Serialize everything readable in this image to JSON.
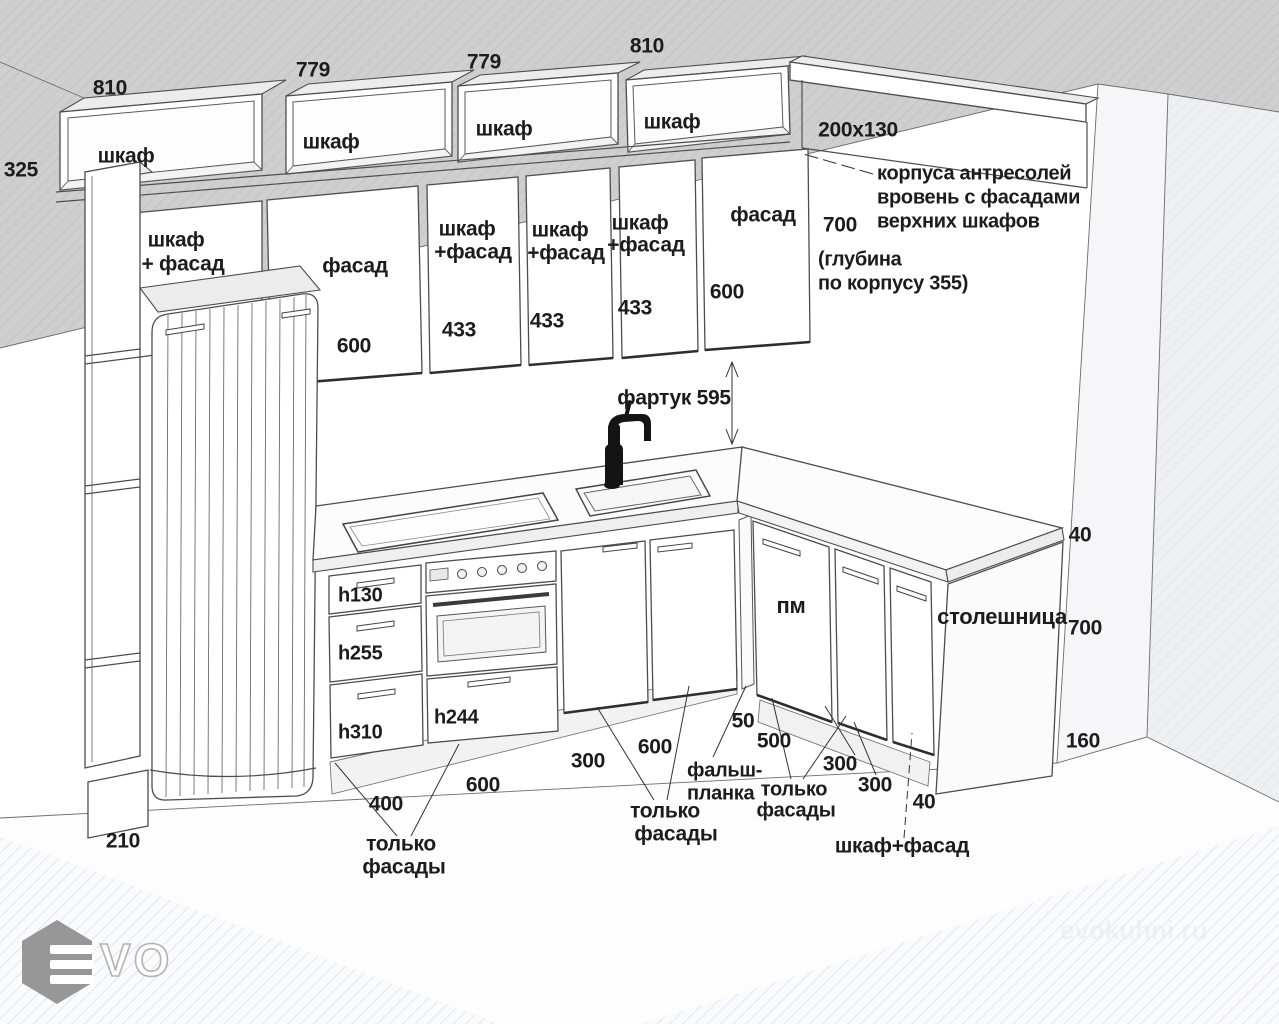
{
  "scene": {
    "top_dims": [
      "810",
      "779",
      "779",
      "810"
    ],
    "left_dim": "325",
    "antresol": [
      "шкаф",
      "шкаф",
      "шкаф",
      "шкаф"
    ],
    "niche_dim": "200x130",
    "note": {
      "l1": "корпуса антресолей",
      "l2": "вровень с фасадами",
      "l3": "верхних шкафов"
    },
    "upper_height": "700",
    "depth_note": {
      "l1": "(глубина",
      "l2": "по корпусу 355)"
    },
    "uppers": {
      "c1l1": "шкаф",
      "c1l2": "+ фасад",
      "c2": "фасад",
      "c2s": "600",
      "c3l1": "шкаф",
      "c3l2": "+фасад",
      "c3s": "433",
      "c4l1": "шкаф",
      "c4l2": "+фасад",
      "c4s": "433",
      "c5l1": "шкаф",
      "c5l2": "+фасад",
      "c5s": "433",
      "c6": "фасад",
      "c6s": "600"
    },
    "apron": "фартук 595",
    "drawers": {
      "d1": "h130",
      "d2": "h255",
      "d3": "h310",
      "d4": "h244"
    },
    "pm": "пм",
    "worktop": {
      "label": "столешница",
      "top": "40",
      "height": "700",
      "plinth": "160"
    },
    "bottom_dims": {
      "b1": "210",
      "b2": "400",
      "b3": "600",
      "b4": "300",
      "b5": "600",
      "b6": "50",
      "b7": "500",
      "b8": "300",
      "b9": "300",
      "b10": "40"
    },
    "callouts": {
      "f1l1": "только",
      "f1l2": "фасады",
      "f2l1": "только",
      "f2l2": "фасады",
      "f3l1": "только",
      "f3l2": "фасады",
      "falsh1": "фальш-",
      "falsh2": "планка",
      "last": "шкаф+фасад"
    }
  },
  "branding": {
    "logo_text": "VO",
    "watermark": "evokuhni.ru"
  }
}
